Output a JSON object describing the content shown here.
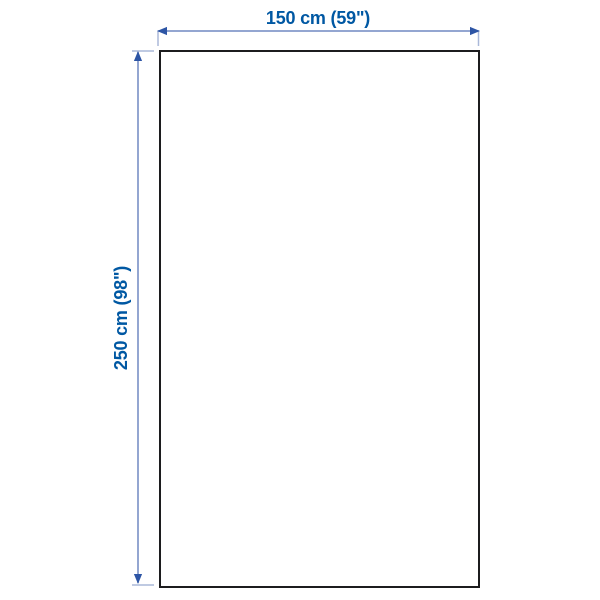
{
  "diagram": {
    "kind": "product-dimension-drawing",
    "width_dimension": {
      "label": "150 cm (59\")",
      "value_cm": 150,
      "value_inches": 59
    },
    "height_dimension": {
      "label": "250 cm (98\")",
      "value_cm": 250,
      "value_inches": 98
    }
  },
  "colors": {
    "background": "#ffffff",
    "outline": "#1c1c1e",
    "label_text": "#0058a3",
    "dimension_line": "#7189c2",
    "extension_tick": "#aab8d9",
    "arrowhead": "#2d55a5"
  }
}
